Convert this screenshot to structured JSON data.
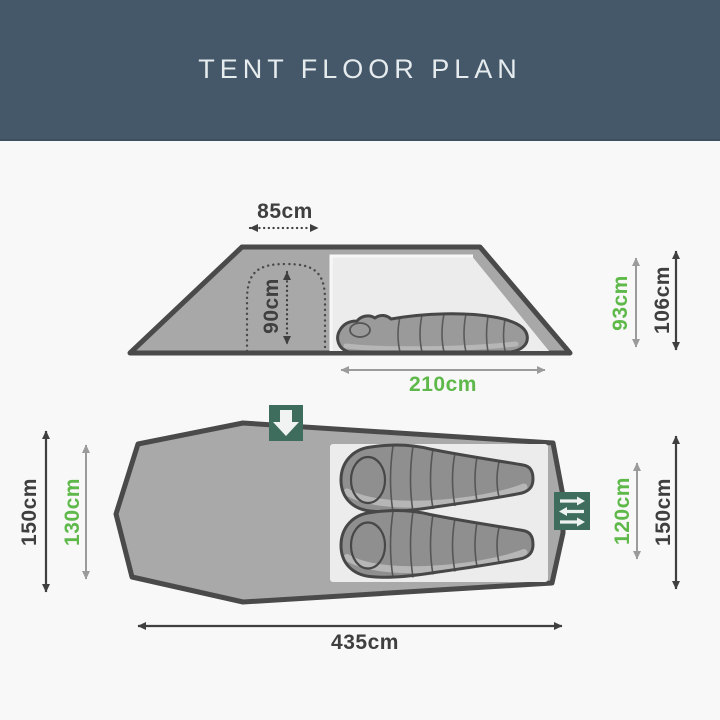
{
  "header": {
    "title": "TENT FLOOR PLAN"
  },
  "colors": {
    "header_bg": "#45586a",
    "page_background": "#f8f8f8",
    "accent_green": "#5eb94a",
    "icon_green": "#3e6d5e",
    "dark_text": "#3f3f3f",
    "tent_fill": "#a8a8a8",
    "inner_tent_fill": "#ececec",
    "outline": "#4a4a4a"
  },
  "side_view": {
    "porch_width": "85cm",
    "door_height": "90cm",
    "inner_height": "93cm",
    "outer_height": "106cm",
    "sleeping_length": "210cm"
  },
  "floor_plan": {
    "outer_width_left": "150cm",
    "inner_width_left": "130cm",
    "inner_width_right": "120cm",
    "outer_width_right": "150cm",
    "outer_length": "435cm",
    "door_icon": "down-arrow-icon",
    "vent_icon": "airflow-arrows-icon"
  }
}
